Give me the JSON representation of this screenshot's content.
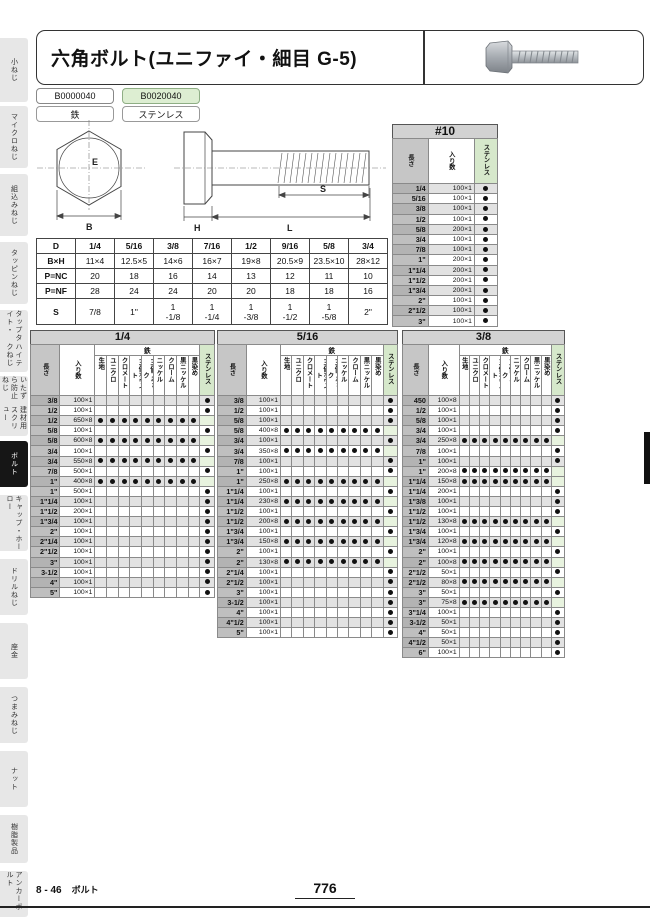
{
  "sidebar": {
    "items": [
      {
        "label": "小ねじ",
        "active": false
      },
      {
        "label": "マイクロねじ",
        "active": false
      },
      {
        "label": "組込みねじ",
        "active": false
      },
      {
        "label": "タッピンねじ",
        "active": false
      },
      {
        "label": "タップタイト・/ハイテクねじ",
        "active": false
      },
      {
        "label": "いたずら防止ねじ/建材用スクリュー",
        "active": false
      },
      {
        "label": "ボルト",
        "active": true
      },
      {
        "label": "キャップ・ホーロー",
        "active": false
      },
      {
        "label": "ドリルねじ",
        "active": false
      },
      {
        "label": "座金",
        "active": false
      },
      {
        "label": "つまみねじ",
        "active": false
      },
      {
        "label": "ナット",
        "active": false
      },
      {
        "label": "樹脂製品",
        "active": false
      },
      {
        "label": "アンカーボルト",
        "active": false
      }
    ]
  },
  "header": {
    "title": "六角ボルト(ユニファイ・細目 G-5)"
  },
  "product_codes": [
    {
      "code": "B0000040",
      "material": "鉄"
    },
    {
      "code": "B0020040",
      "material": "ステンレス"
    }
  ],
  "diagram": {
    "b": "B",
    "e": "E",
    "h": "H",
    "l": "L",
    "s": "S"
  },
  "spec_table": {
    "col_header": "D",
    "sizes": [
      "1/4",
      "5/16",
      "3/8",
      "7/16",
      "1/2",
      "9/16",
      "5/8",
      "3/4"
    ],
    "rows": [
      {
        "label": "B×H",
        "values": [
          "11×4",
          "12.5×5",
          "14×6",
          "16×7",
          "19×8",
          "20.5×9",
          "23.5×10",
          "28×12"
        ]
      },
      {
        "label": "P=NC",
        "values": [
          "20",
          "18",
          "16",
          "14",
          "13",
          "12",
          "11",
          "10"
        ]
      },
      {
        "label": "P=NF",
        "values": [
          "28",
          "24",
          "24",
          "20",
          "20",
          "18",
          "18",
          "16"
        ]
      },
      {
        "label": "S",
        "values": [
          "7/8",
          "1\"",
          "1\n-1/8",
          "1\n-1/4",
          "1\n-3/8",
          "1\n-1/2",
          "1\n-5/8",
          "2\""
        ]
      }
    ]
  },
  "column_labels": {
    "length": "長さ",
    "quantity": "入り数",
    "iron_group": "鉄",
    "stainless": "ステンレス",
    "finishes": [
      "生地",
      "ユニクロ",
      "クロメート",
      "三価ホワイト",
      "三価ブラック",
      "ニッケル",
      "クローム",
      "黒ニッケル",
      "黒染め"
    ]
  },
  "size10_table": {
    "title": "#10",
    "rows": [
      [
        "1/4",
        "100×1"
      ],
      [
        "5/16",
        "100×1"
      ],
      [
        "3/8",
        "100×1"
      ],
      [
        "1/2",
        "100×1"
      ],
      [
        "5/8",
        "200×1"
      ],
      [
        "3/4",
        "100×1"
      ],
      [
        "7/8",
        "100×1"
      ],
      [
        "1\"",
        "200×1"
      ],
      [
        "1\"1/4",
        "200×1"
      ],
      [
        "1\"1/2",
        "200×1"
      ],
      [
        "1\"3/4",
        "200×1"
      ],
      [
        "2\"",
        "100×1"
      ],
      [
        "2\"1/2",
        "100×1"
      ],
      [
        "3\"",
        "100×1"
      ]
    ]
  },
  "product_tables": [
    {
      "title": "1/4",
      "rows": [
        [
          "3/8",
          "100×1",
          "ss"
        ],
        [
          "1/2",
          "100×1",
          "ss"
        ],
        [
          "1/2",
          "650×8",
          "fe"
        ],
        [
          "5/8",
          "100×1",
          "ss"
        ],
        [
          "5/8",
          "600×8",
          "fe"
        ],
        [
          "3/4",
          "100×1",
          "ss"
        ],
        [
          "3/4",
          "550×8",
          "fe"
        ],
        [
          "7/8",
          "500×1",
          "ss"
        ],
        [
          "1\"",
          "400×8",
          "fe"
        ],
        [
          "1\"",
          "500×1",
          "ss"
        ],
        [
          "1\"1/4",
          "100×1",
          "ss"
        ],
        [
          "1\"1/2",
          "200×1",
          "ss"
        ],
        [
          "1\"3/4",
          "100×1",
          "ss"
        ],
        [
          "2\"",
          "100×1",
          "ss"
        ],
        [
          "2\"1/4",
          "100×1",
          "ss"
        ],
        [
          "2\"1/2",
          "100×1",
          "ss"
        ],
        [
          "3\"",
          "100×1",
          "ss"
        ],
        [
          "3-1/2",
          "100×1",
          "ss"
        ],
        [
          "4\"",
          "100×1",
          "ss"
        ],
        [
          "5\"",
          "100×1",
          "ss"
        ]
      ]
    },
    {
      "title": "5/16",
      "rows": [
        [
          "3/8",
          "100×1",
          "ss"
        ],
        [
          "1/2",
          "100×1",
          "ss"
        ],
        [
          "5/8",
          "100×1",
          "ss"
        ],
        [
          "5/8",
          "400×8",
          "fe"
        ],
        [
          "3/4",
          "100×1",
          "ss"
        ],
        [
          "3/4",
          "350×8",
          "fe"
        ],
        [
          "7/8",
          "100×1",
          "ss"
        ],
        [
          "1\"",
          "100×1",
          "ss"
        ],
        [
          "1\"",
          "250×8",
          "fe"
        ],
        [
          "1\"1/4",
          "100×1",
          "ss"
        ],
        [
          "1\"1/4",
          "230×8",
          "fe"
        ],
        [
          "1\"1/2",
          "100×1",
          "ss"
        ],
        [
          "1\"1/2",
          "200×8",
          "fe"
        ],
        [
          "1\"3/4",
          "100×1",
          "ss"
        ],
        [
          "1\"3/4",
          "150×8",
          "fe"
        ],
        [
          "2\"",
          "100×1",
          "ss"
        ],
        [
          "2\"",
          "130×8",
          "fe"
        ],
        [
          "2\"1/4",
          "100×1",
          "ss"
        ],
        [
          "2\"1/2",
          "100×1",
          "ss"
        ],
        [
          "3\"",
          "100×1",
          "ss"
        ],
        [
          "3-1/2",
          "100×1",
          "ss"
        ],
        [
          "4\"",
          "100×1",
          "ss"
        ],
        [
          "4\"1/2",
          "100×1",
          "ss"
        ],
        [
          "5\"",
          "100×1",
          "ss"
        ]
      ]
    },
    {
      "title": "3/8",
      "rows": [
        [
          "450",
          "100×8",
          "ss"
        ],
        [
          "1/2",
          "100×1",
          "ss"
        ],
        [
          "5/8",
          "100×1",
          "ss"
        ],
        [
          "3/4",
          "100×1",
          "ss"
        ],
        [
          "3/4",
          "250×8",
          "fe"
        ],
        [
          "7/8",
          "100×1",
          "ss"
        ],
        [
          "1\"",
          "100×1",
          "ss"
        ],
        [
          "1\"",
          "200×8",
          "fe"
        ],
        [
          "1\"1/4",
          "150×8",
          "fe"
        ],
        [
          "1\"1/4",
          "200×1",
          "ss"
        ],
        [
          "1\"3/8",
          "100×1",
          "ss"
        ],
        [
          "1\"1/2",
          "100×1",
          "ss"
        ],
        [
          "1\"1/2",
          "130×8",
          "fe"
        ],
        [
          "1\"3/4",
          "100×1",
          "ss"
        ],
        [
          "1\"3/4",
          "120×8",
          "fe"
        ],
        [
          "2\"",
          "100×1",
          "ss"
        ],
        [
          "2\"",
          "100×8",
          "fe"
        ],
        [
          "2\"1/2",
          "50×1",
          "ss"
        ],
        [
          "2\"1/2",
          "80×8",
          "fe"
        ],
        [
          "3\"",
          "50×1",
          "ss"
        ],
        [
          "3\"",
          "75×8",
          "fe"
        ],
        [
          "3\"1/4",
          "100×1",
          "ss"
        ],
        [
          "3-1/2",
          "50×1",
          "ss"
        ],
        [
          "4\"",
          "50×1",
          "ss"
        ],
        [
          "4\"1/2",
          "50×1",
          "ss"
        ],
        [
          "6\"",
          "100×1",
          "ss"
        ]
      ]
    }
  ],
  "footer": {
    "page_ref": "8 - 46",
    "section": "ボルト",
    "page_number": "776"
  },
  "colors": {
    "stainless_header": "#d6e8cb",
    "stainless_tint": "#e8f3df",
    "badge_green": "#ddeed2",
    "active_tab": "#161616",
    "title_bar": "#d2d2d2"
  }
}
